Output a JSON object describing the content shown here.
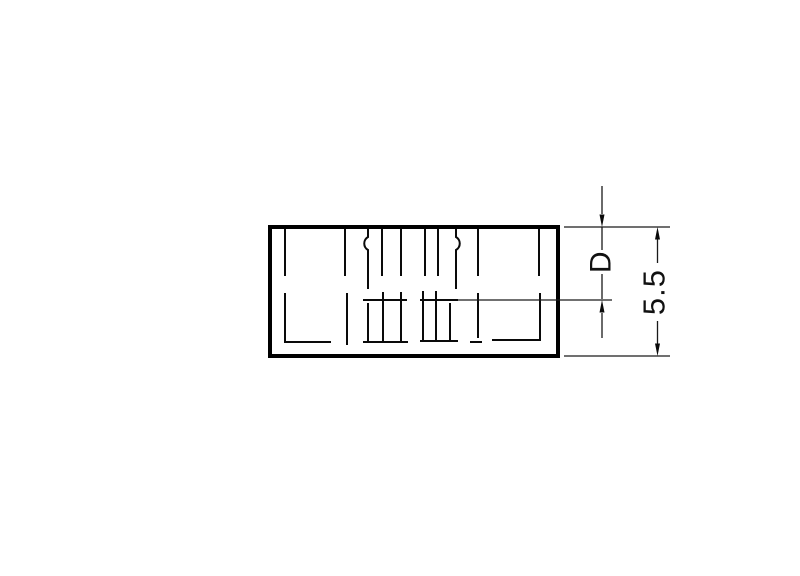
{
  "page": {
    "background_color": "#ffffff",
    "content": "technical-dimension-drawing"
  },
  "drawing": {
    "line_color": "#000000",
    "outline": {
      "description": "rectangular part end-view with hidden (dashed) internal lines"
    },
    "dimensions": {
      "depth": {
        "label": "D"
      },
      "height": {
        "label": "5.5"
      }
    }
  }
}
